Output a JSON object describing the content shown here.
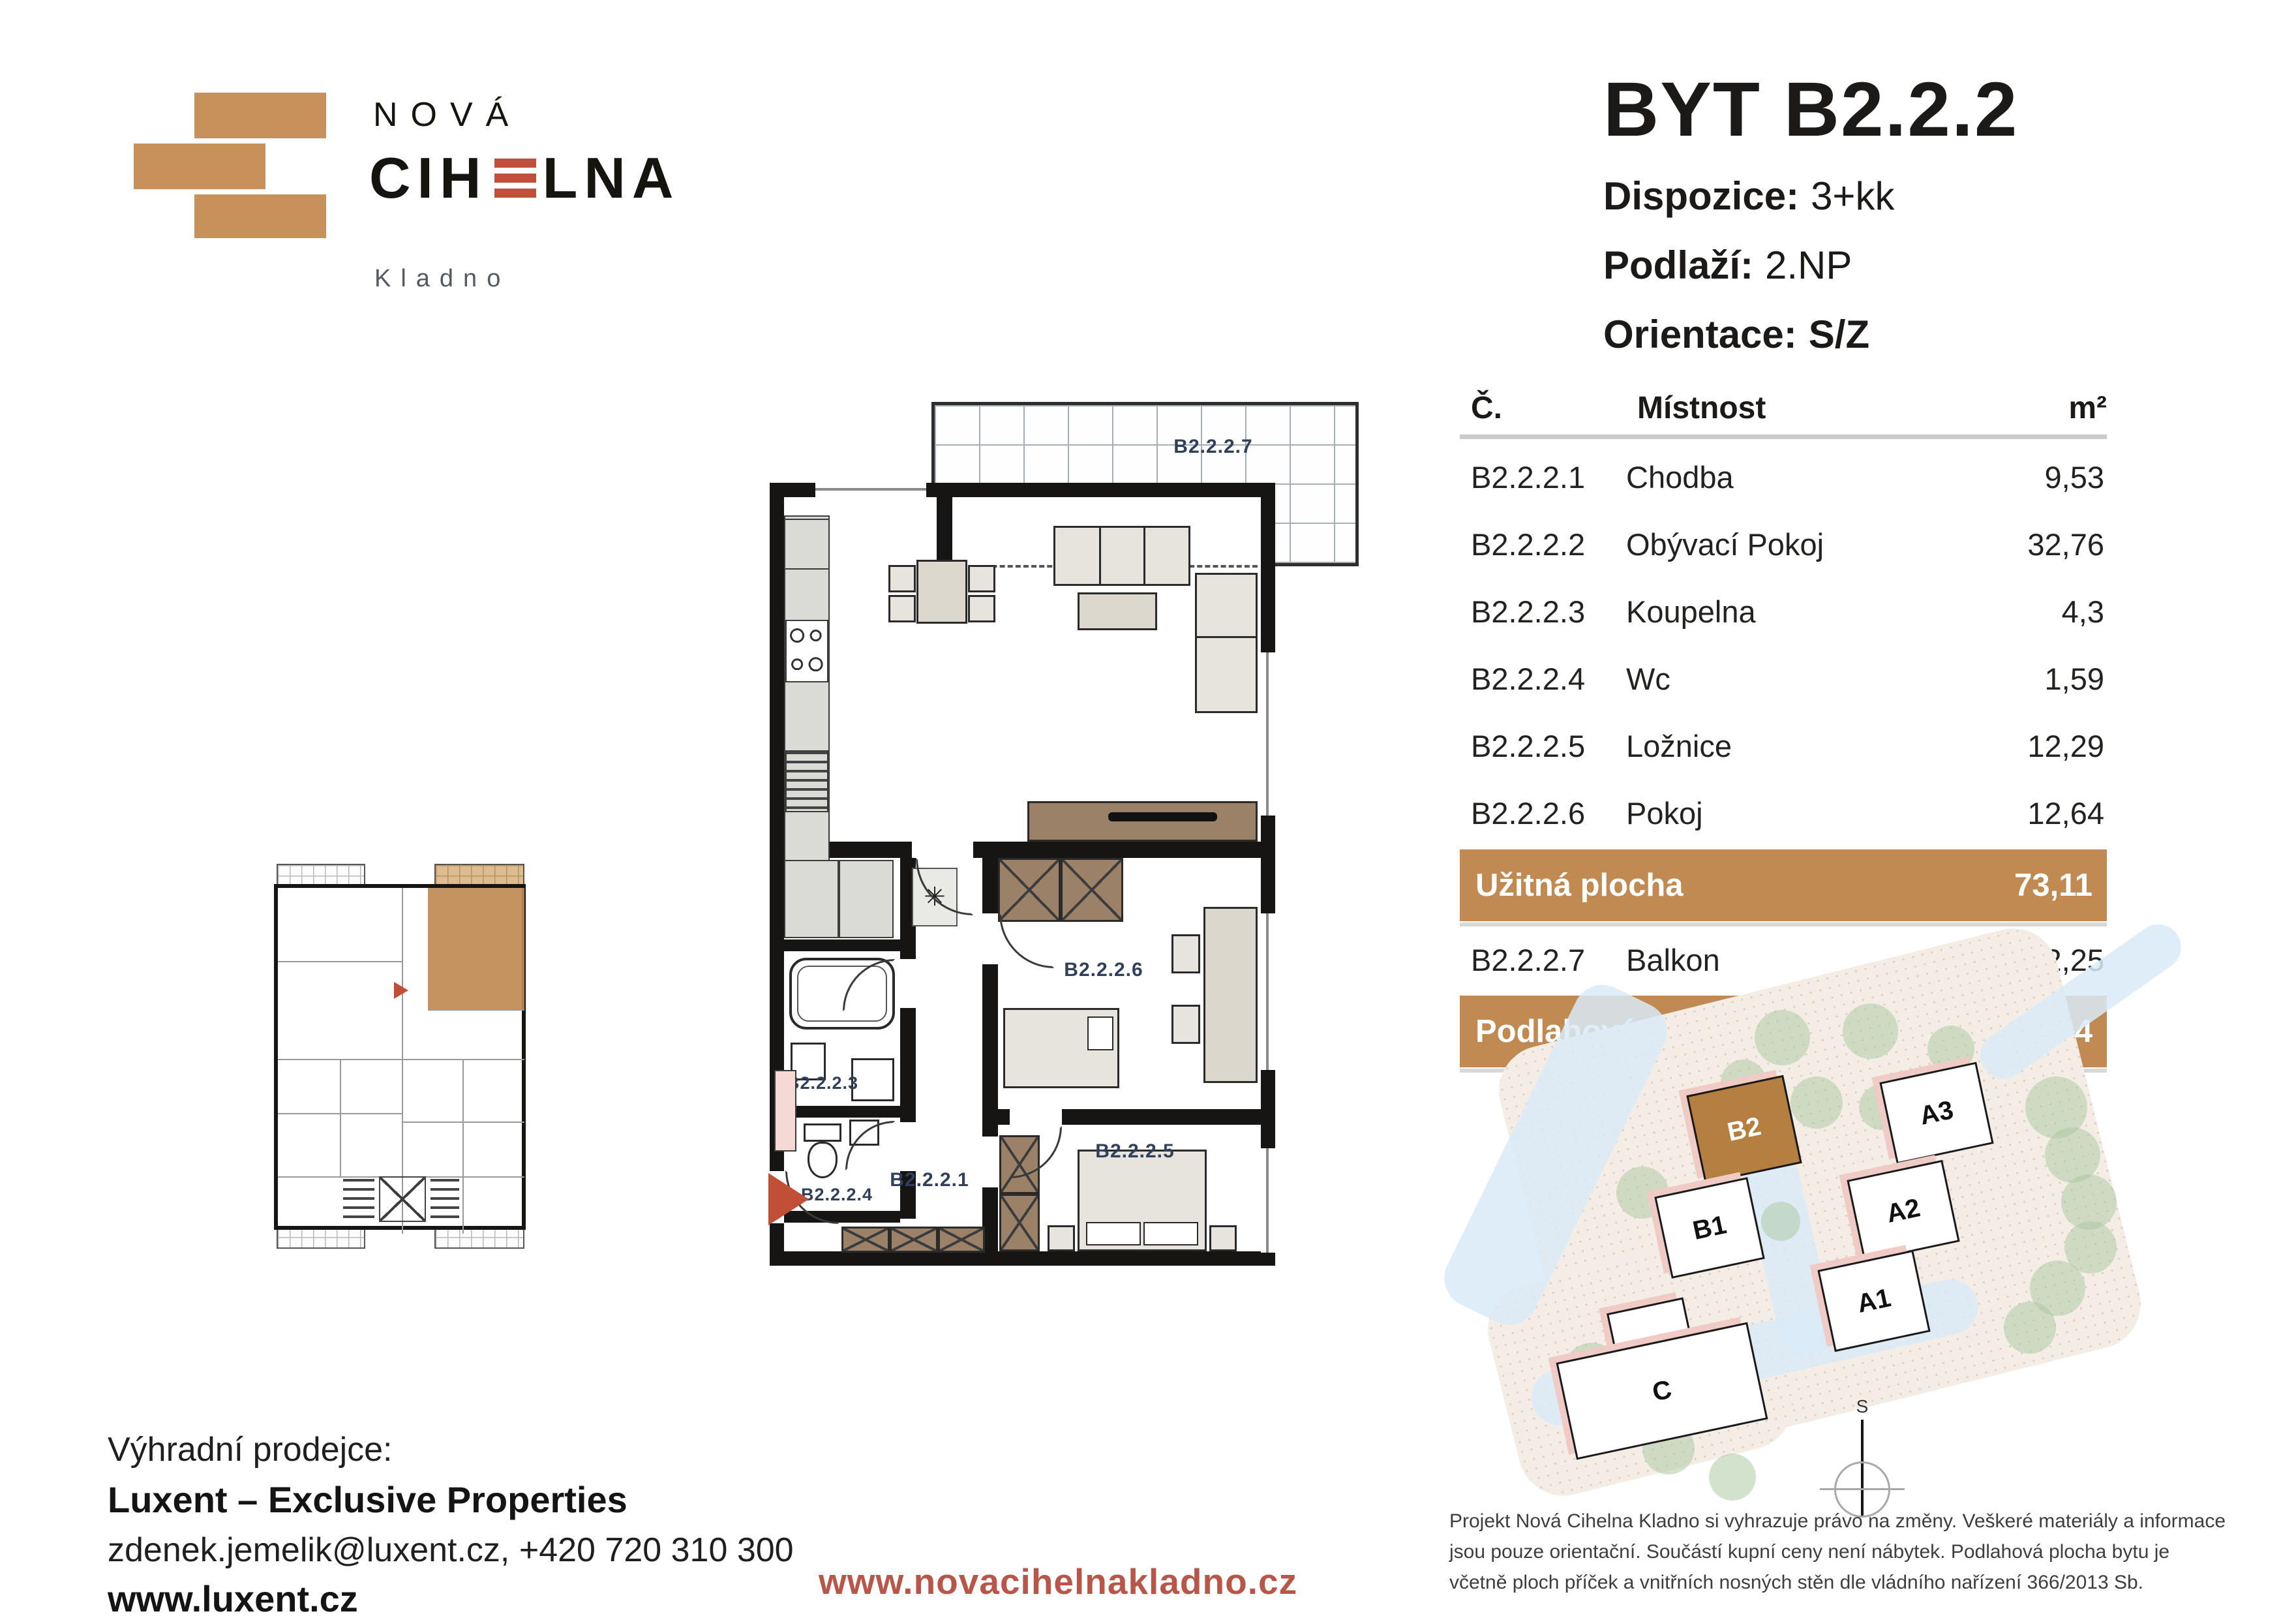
{
  "logo": {
    "name_top": "NOVÁ",
    "name_main_pre": "CIH",
    "name_main_post": "LNA",
    "city": "Kladno"
  },
  "header": {
    "title": "BYT B2.2.2",
    "specs": [
      {
        "label": "Dispozice:",
        "value": "3+kk"
      },
      {
        "label": "Podlaží:",
        "value": "2.NP"
      },
      {
        "label": "Orientace:",
        "value": "S/Z"
      }
    ]
  },
  "table": {
    "columns": {
      "no": "Č.",
      "room": "Místnost",
      "area": "m²"
    },
    "rows": [
      {
        "no": "B2.2.2.1",
        "room": "Chodba",
        "area": "9,53"
      },
      {
        "no": "B2.2.2.2",
        "room": "Obývací Pokoj",
        "area": "32,76"
      },
      {
        "no": "B2.2.2.3",
        "room": "Koupelna",
        "area": "4,3"
      },
      {
        "no": "B2.2.2.4",
        "room": "Wc",
        "area": "1,59"
      },
      {
        "no": "B2.2.2.5",
        "room": "Ložnice",
        "area": "12,29"
      },
      {
        "no": "B2.2.2.6",
        "room": "Pokoj",
        "area": "12,64"
      }
    ],
    "summary_useful": {
      "label": "Užitná plocha",
      "value": "73,11"
    },
    "balcony_row": {
      "no": "B2.2.2.7",
      "room": "Balkon",
      "area": "12,25"
    },
    "summary_floor": {
      "label": "Podlahová plocha",
      "value": "76,44"
    }
  },
  "plan": {
    "labels": {
      "hallway": "B2.2.2.1",
      "living": "B2.2.2.2",
      "bathroom": "B2.2.2.3",
      "wc": "B2.2.2.4",
      "bedroom": "B2.2.2.5",
      "room": "B2.2.2.6",
      "balcony": "B2.2.2.7"
    }
  },
  "site": {
    "b2": "B2",
    "b1": "B1",
    "a3": "A3",
    "a2": "A2",
    "a1": "A1",
    "c": "C",
    "compass": "S"
  },
  "footer": {
    "seller_intro": "Výhradní prodejce:",
    "seller_name": "Luxent – Exclusive Properties",
    "seller_contact": "zdenek.jemelik@luxent.cz, +420 720 310 300",
    "seller_web": "www.luxent.cz",
    "project_web": "www.novacihelnakladno.cz",
    "disclaimer": "Projekt Nová Cihelna Kladno si vyhrazuje právo na změny. Veškeré materiály a informace jsou pouze orientační. Součástí kupní ceny není nábytek. Podlahová plocha bytu je včetně ploch příček a vnitřních nosných stěn dle vládního nařízení 366/2013 Sb."
  },
  "colors": {
    "brand_tan": "#C6915A",
    "table_bar": "#C08A52",
    "accent_red": "#C14F38",
    "link_red": "#B85649",
    "label_slate": "#31405A"
  }
}
